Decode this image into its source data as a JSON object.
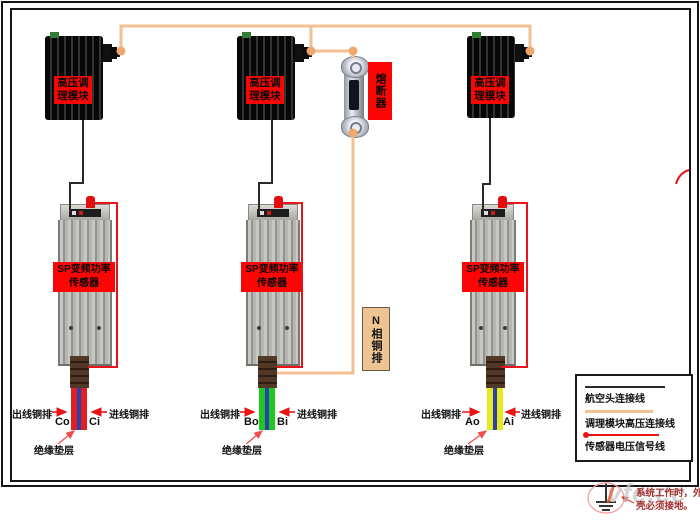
{
  "modules": [
    {
      "label": "高压调理模块"
    },
    {
      "label": "高压调理模块"
    },
    {
      "label": "高压调理模块"
    }
  ],
  "sensors": [
    {
      "label_line1": "SP变频功率",
      "label_line2": "传感器"
    },
    {
      "label_line1": "SP变频功率",
      "label_line2": "传感器"
    },
    {
      "label_line1": "SP变频功率",
      "label_line2": "传感器"
    }
  ],
  "fuse": {
    "label": "熔断器"
  },
  "n_bus_label": "N相铜排",
  "columns": [
    {
      "out_label": "出线铜排",
      "in_label": "进线铜排",
      "out_terminal": "Co",
      "in_terminal": "Ci",
      "insulation_label": "绝缘垫层",
      "bar_color": "#e02020"
    },
    {
      "out_label": "出线铜排",
      "in_label": "进线铜排",
      "out_terminal": "Bo",
      "in_terminal": "Bi",
      "insulation_label": "绝缘垫层",
      "bar_color": "#1ec81e"
    },
    {
      "out_label": "出线铜排",
      "in_label": "进线铜排",
      "out_terminal": "Ao",
      "in_terminal": "Ai",
      "insulation_label": "绝缘垫层",
      "bar_color": "#e8e820"
    }
  ],
  "legend": {
    "items": [
      {
        "line_style": "black-line",
        "label": "航空头连接线"
      },
      {
        "line_style": "orange-line",
        "label": "调理模块高压连接线"
      },
      {
        "line_style": "red-line-with-dot",
        "label": "传感器电压信号线"
      }
    ]
  },
  "footnote": {
    "line1": "系统工作时，外",
    "line2": "壳必须接地。"
  },
  "watermark": "vfe.cc",
  "colors": {
    "aviation_cable": "#2a2a2a",
    "hv_connection": "#f2c091",
    "signal_line": "#e8131b",
    "label_background": "#fe0505",
    "insulation_stripe": "#2b3fae",
    "n_label_background": "#efc493"
  }
}
